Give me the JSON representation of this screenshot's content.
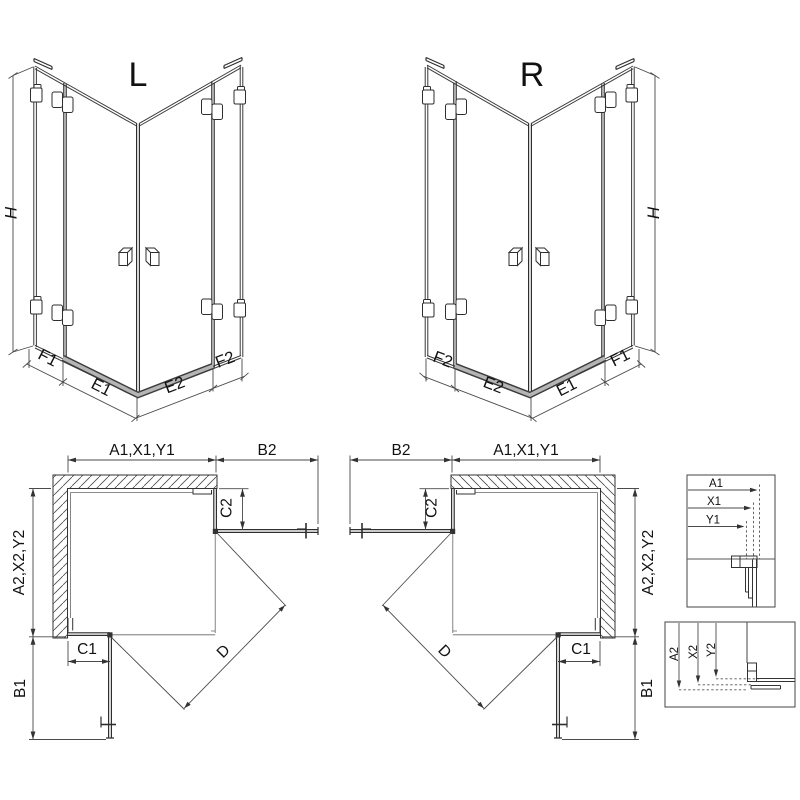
{
  "drawing": {
    "iso_left": {
      "title": "L",
      "height": "H",
      "seg1": "F1",
      "seg2": "E1",
      "seg3": "E2",
      "seg4": "F2"
    },
    "iso_right": {
      "title": "R",
      "height": "H",
      "seg1": "F2",
      "seg2": "E2",
      "seg3": "E1",
      "seg4": "F1"
    },
    "plan_left": {
      "width_top": "A1,X1,Y1",
      "door_top": "B2",
      "fixed_side": "C2",
      "depth_side": "A2,X2,Y2",
      "fixed_bottom": "C1",
      "door_bottom": "B1",
      "diagonal": "D"
    },
    "plan_right": {
      "width_top": "A1,X1,Y1",
      "door_top": "B2",
      "fixed_side": "C2",
      "depth_side": "A2,X2,Y2",
      "fixed_bottom": "C1",
      "door_bottom": "B1",
      "diagonal": "D"
    },
    "detail_widths": {
      "l1": "A1",
      "l2": "X1",
      "l3": "Y1"
    },
    "detail_depths": {
      "l1": "A2",
      "l2": "X2",
      "l3": "Y2"
    }
  },
  "colors": {
    "line": "#333333",
    "dimension": "#4a4a4a",
    "text": "#111111",
    "sill_fill": "#b5b5b5",
    "hatch": "#4a4a4a",
    "background": "#ffffff"
  }
}
